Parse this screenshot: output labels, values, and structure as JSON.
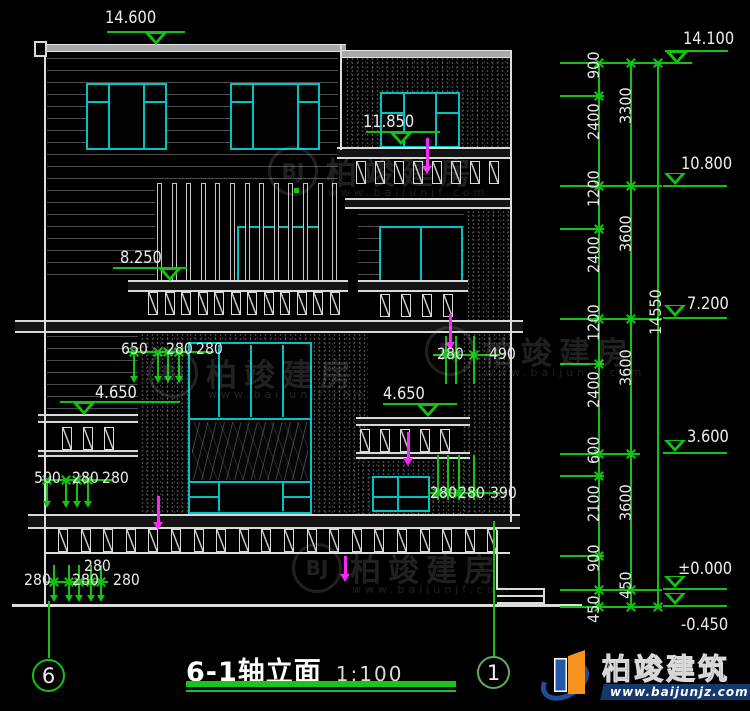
{
  "colors": {
    "green": "#12c312",
    "cyan": "#00c3c3",
    "magenta": "#f628f6",
    "line_white": "#dcdcdc",
    "text_white": "#e9e9e9"
  },
  "drawing": {
    "title": "6-1轴立面",
    "scale": "1:100",
    "axis_left": "6",
    "axis_right": "1"
  },
  "levels": [
    {
      "text": "14.600",
      "tx": 105,
      "ty": 8,
      "lx": 107,
      "lw": 78,
      "ly": 31,
      "tcx": 156,
      "dir": "below"
    },
    {
      "text": "11.850",
      "tx": 363,
      "ty": 112,
      "lx": 366,
      "lw": 74,
      "ly": 131,
      "tcx": 401,
      "dir": "below"
    },
    {
      "text": "8.250",
      "tx": 120,
      "ty": 248,
      "lx": 113,
      "lw": 74,
      "ly": 267,
      "tcx": 170,
      "dir": "below"
    },
    {
      "text": "4.650",
      "tx": 95,
      "ty": 383,
      "lx": 60,
      "lw": 120,
      "ly": 401,
      "tcx": 84,
      "dir": "below"
    },
    {
      "text": "4.650",
      "tx": 383,
      "ty": 384,
      "lx": 383,
      "lw": 74,
      "ly": 403,
      "tcx": 428,
      "dir": "below"
    },
    {
      "text": "14.100",
      "tx": 683,
      "ty": 29,
      "lx": 665,
      "lw": 63,
      "ly": 50,
      "tcx": 677,
      "dir": "below"
    },
    {
      "text": "10.800",
      "tx": 681,
      "ty": 154,
      "lx": 663,
      "lw": 64,
      "ly": 185,
      "tcx": 675,
      "dir": "above"
    },
    {
      "text": "7.200",
      "tx": 687,
      "ty": 294,
      "lx": 663,
      "lw": 64,
      "ly": 317,
      "tcx": 675,
      "dir": "above"
    },
    {
      "text": "3.600",
      "tx": 687,
      "ty": 427,
      "lx": 663,
      "lw": 64,
      "ly": 452,
      "tcx": 675,
      "dir": "above"
    },
    {
      "text": "±0.000",
      "tx": 678,
      "ty": 559,
      "lx": 663,
      "lw": 64,
      "ly": 588,
      "tcx": 675,
      "dir": "above"
    },
    {
      "text": "-0.450",
      "tx": 681,
      "ty": 615,
      "lx": 663,
      "lw": 64,
      "ly": 605,
      "tcx": 675,
      "dir": "above"
    }
  ],
  "chain_dims": [
    {
      "text": "900",
      "x": 584,
      "y": 79
    },
    {
      "text": "2400",
      "x": 584,
      "y": 140
    },
    {
      "text": "1200",
      "x": 584,
      "y": 207
    },
    {
      "text": "2400",
      "x": 584,
      "y": 273
    },
    {
      "text": "1200",
      "x": 584,
      "y": 341
    },
    {
      "text": "2400",
      "x": 584,
      "y": 408
    },
    {
      "text": "600",
      "x": 584,
      "y": 464
    },
    {
      "text": "2100",
      "x": 584,
      "y": 522
    },
    {
      "text": "900",
      "x": 584,
      "y": 572
    },
    {
      "text": "450",
      "x": 584,
      "y": 623
    },
    {
      "text": "3300",
      "x": 616,
      "y": 124
    },
    {
      "text": "3600",
      "x": 616,
      "y": 252
    },
    {
      "text": "3600",
      "x": 616,
      "y": 386
    },
    {
      "text": "3600",
      "x": 616,
      "y": 521
    },
    {
      "text": "450",
      "x": 616,
      "y": 599
    },
    {
      "text": "14550",
      "x": 646,
      "y": 335
    }
  ],
  "linear_dims": [
    {
      "text": "650",
      "x": 121,
      "y": 339
    },
    {
      "text": "280",
      "x": 166,
      "y": 339
    },
    {
      "text": "280",
      "x": 196,
      "y": 339
    },
    {
      "text": "280",
      "x": 437,
      "y": 344
    },
    {
      "text": "490",
      "x": 489,
      "y": 344
    },
    {
      "text": "500",
      "x": 34,
      "y": 468
    },
    {
      "text": "280",
      "x": 72,
      "y": 468
    },
    {
      "text": "280",
      "x": 102,
      "y": 468
    },
    {
      "text": "280",
      "x": 430,
      "y": 483
    },
    {
      "text": "280",
      "x": 458,
      "y": 483
    },
    {
      "text": "390",
      "x": 490,
      "y": 483
    },
    {
      "text": "280",
      "x": 84,
      "y": 556
    },
    {
      "text": "280",
      "x": 24,
      "y": 570
    },
    {
      "text": "280",
      "x": 72,
      "y": 570
    },
    {
      "text": "280",
      "x": 113,
      "y": 570
    }
  ],
  "watermark": {
    "monogram": "BJ",
    "text": "柏竣建房",
    "url": "www.baijunjf.com",
    "positions": [
      {
        "x": 268,
        "y": 146
      },
      {
        "x": 425,
        "y": 326
      },
      {
        "x": 148,
        "y": 348
      },
      {
        "x": 292,
        "y": 543
      }
    ]
  },
  "logo": {
    "text": "柏竣建筑",
    "url": "www.baijunjz.com"
  }
}
